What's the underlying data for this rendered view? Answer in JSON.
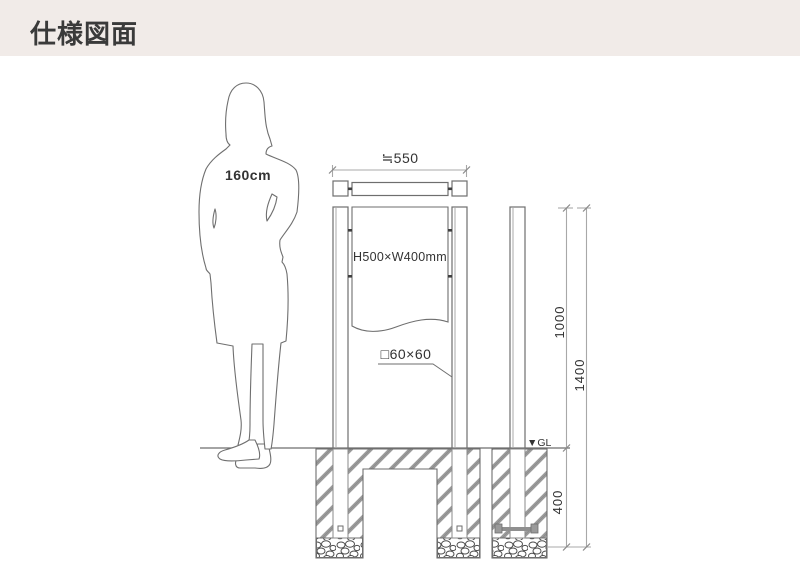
{
  "header": {
    "title": "仕様図面"
  },
  "drawing": {
    "person": {
      "height_label": "160cm"
    },
    "labels": {
      "top_width": "≒550",
      "panel_size": "H500×W400mm",
      "post_section": "□60×60",
      "ground_level": "▼GL"
    },
    "dims": {
      "above_ground": "1000",
      "total_height": "1400",
      "below_ground": "400"
    },
    "colors": {
      "header_bg": "#f1ebe8",
      "title_text": "#3a3a3a",
      "line": "#6e6e6e",
      "dim_line": "#a8a8a8",
      "label_text": "#333333",
      "hatch": "#9b9b9b"
    }
  }
}
